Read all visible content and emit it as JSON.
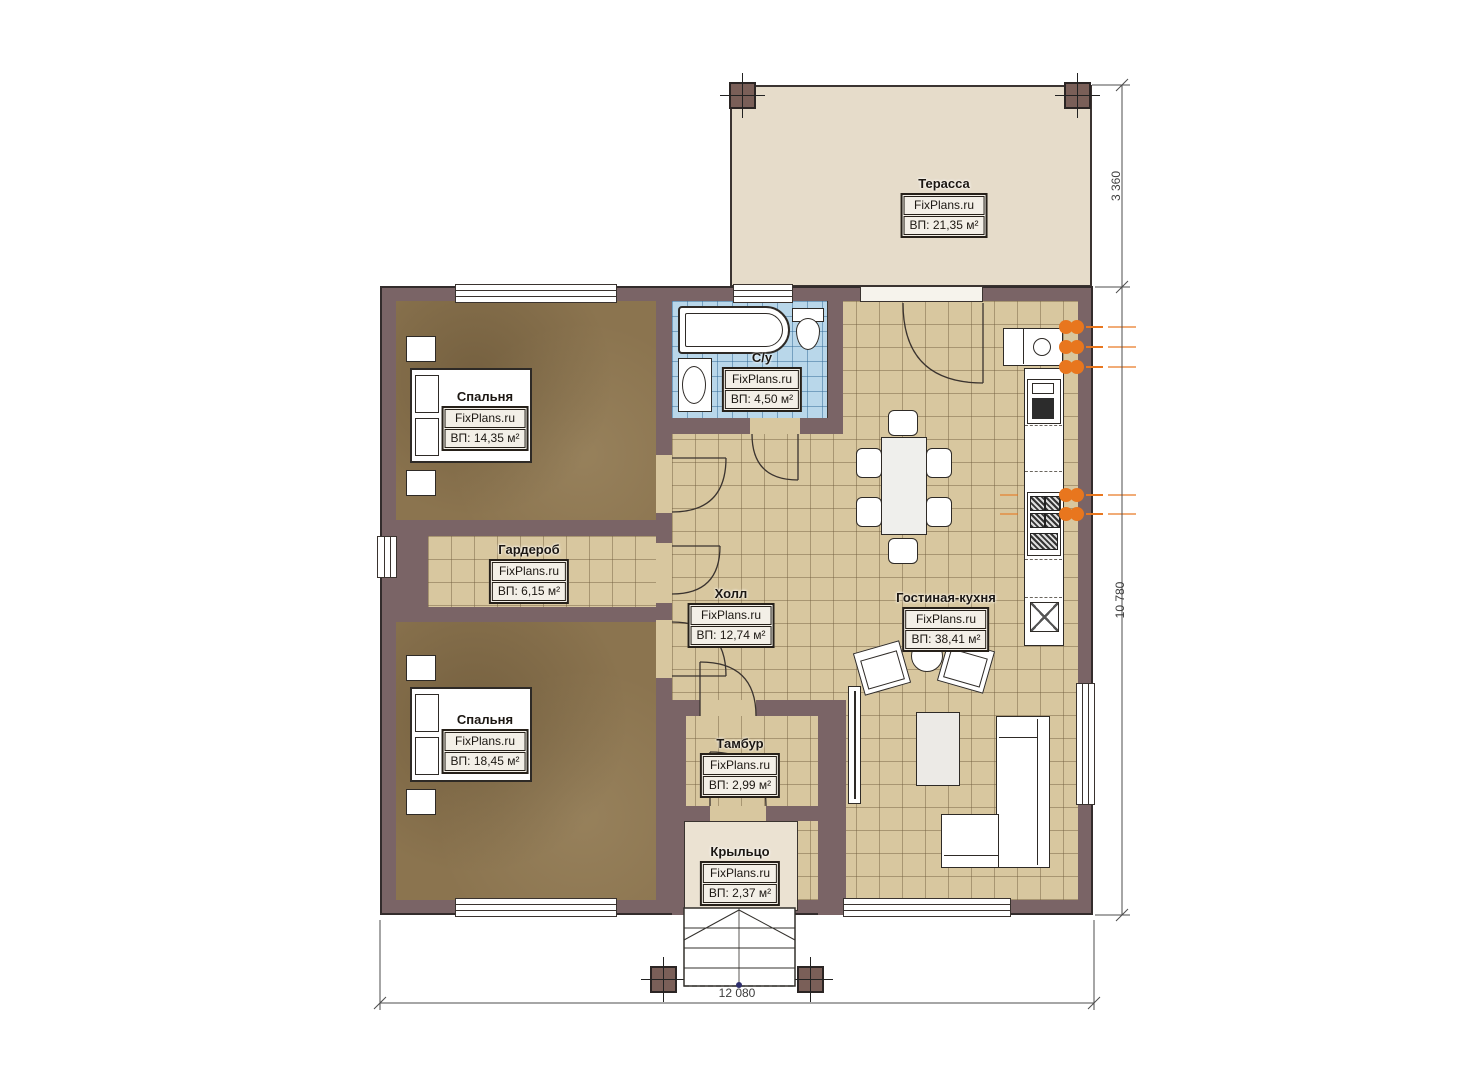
{
  "brand": "FixPlans.ru",
  "rooms": {
    "terrace": {
      "name": "Терасса",
      "area": "ВП: 21,35 м²"
    },
    "bedroom1": {
      "name": "Спальня",
      "area": "ВП: 14,35 м²"
    },
    "wardrobe": {
      "name": "Гардероб",
      "area": "ВП: 6,15 м²"
    },
    "bathroom": {
      "name": "С/у",
      "area": "ВП: 4,50 м²"
    },
    "hall": {
      "name": "Холл",
      "area": "ВП: 12,74 м²"
    },
    "living_kitchen": {
      "name": "Гостиная-кухня",
      "area": "ВП: 38,41 м²"
    },
    "bedroom2": {
      "name": "Спальня",
      "area": "ВП: 18,45 м²"
    },
    "tambur": {
      "name": "Тамбур",
      "area": "ВП: 2,99 м²"
    },
    "porch": {
      "name": "Крыльцо",
      "area": "ВП: 2,37 м²"
    }
  },
  "dimensions": {
    "terrace_depth": "3 360",
    "building_depth": "10 780",
    "building_width": "12 080"
  },
  "colors": {
    "wall": "#7a6466",
    "tile_beige": "#d8c79f",
    "tile_blue": "#b9d7ea",
    "floor_brown": "#8b744f",
    "terrace": "#e6dcca",
    "porch": "#ebe2d2",
    "accent_orange": "#e8761e"
  }
}
